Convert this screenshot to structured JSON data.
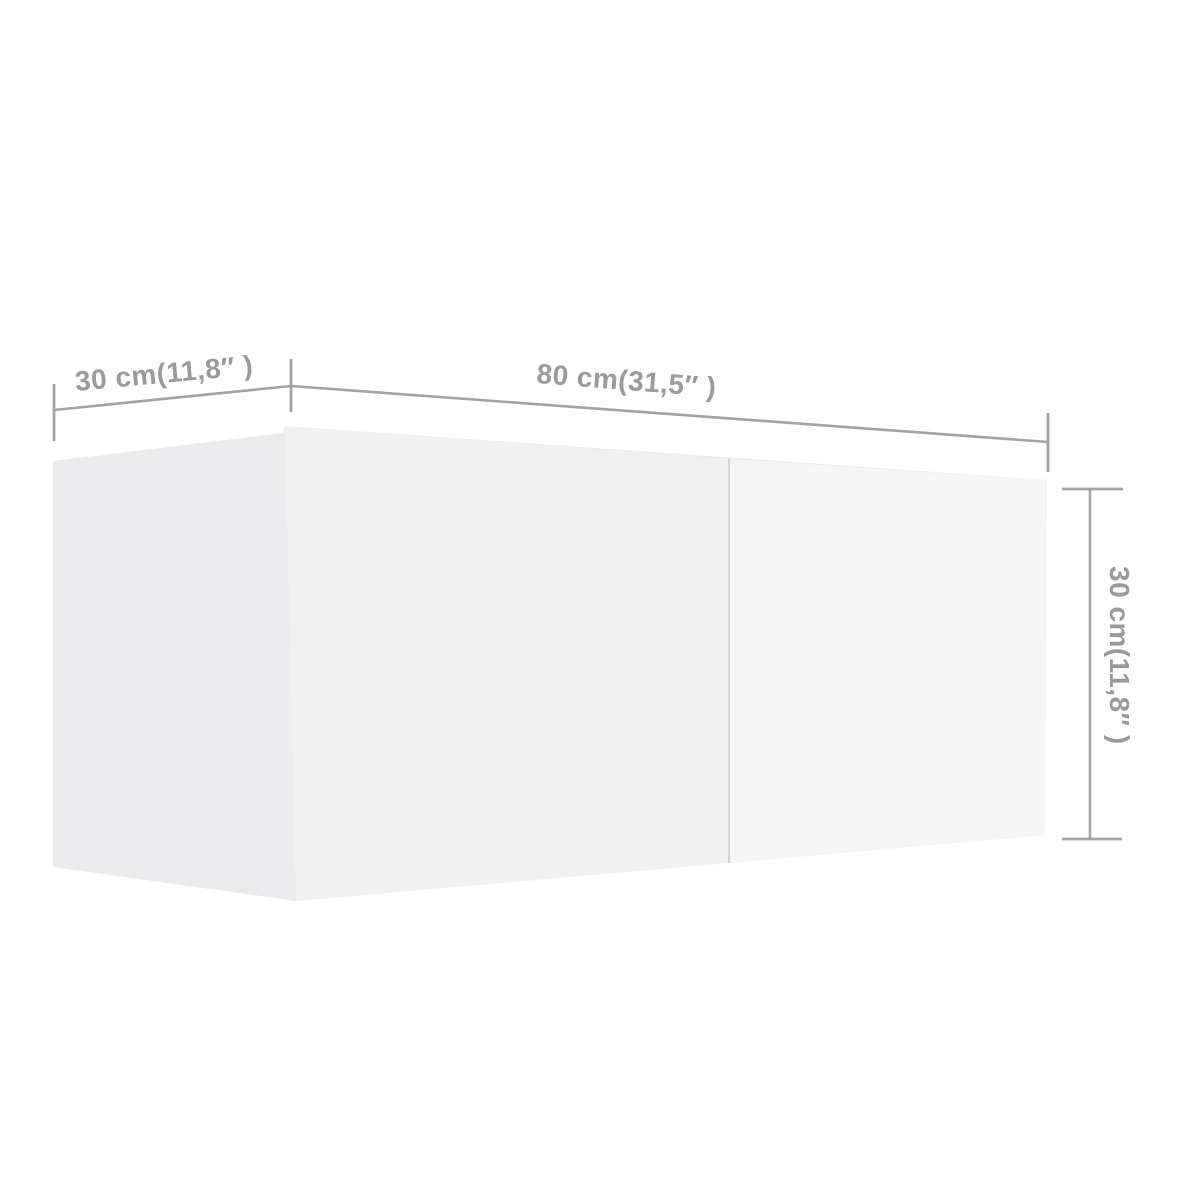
{
  "page": {
    "background": "#ffffff"
  },
  "diagram": {
    "type": "product-dimension-diagram",
    "subject": "wall-mounted TV cabinet shown in 3D perspective",
    "labels": {
      "depth": "30 cm(11,8″ )",
      "width": "80 cm(31,5″ )",
      "height": "30 cm(11,8″ )"
    },
    "dimensions": {
      "depth_cm": 30,
      "depth_inch": "11,8″",
      "width_cm": 80,
      "width_inch": "31,5″",
      "height_cm": 30,
      "height_inch": "11,8″"
    },
    "colors": {
      "dimension_line": "#a2a2a2",
      "dimension_text": "#9a9a9a",
      "side_panel": "#ebebed",
      "left_door": "#f0f0f1",
      "right_door": "#f5f5f6",
      "door_divider": "#cdcdcf"
    }
  }
}
